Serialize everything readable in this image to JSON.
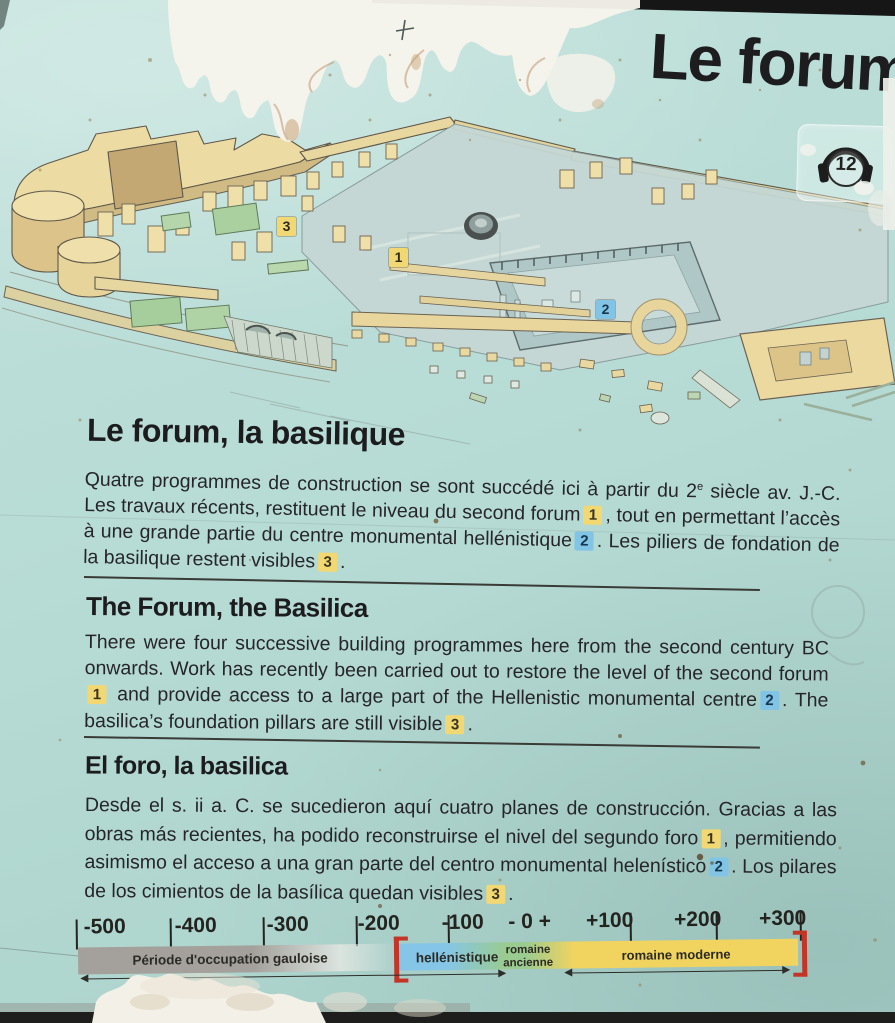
{
  "panel": {
    "title": "Le forum",
    "audio_number": "12"
  },
  "map": {
    "markers": [
      {
        "n": "3",
        "color": "yellow"
      },
      {
        "n": "1",
        "color": "yellow"
      },
      {
        "n": "2",
        "color": "blue"
      }
    ]
  },
  "sections": [
    {
      "id": "fr",
      "heading": "Le forum, la basilique",
      "segments": [
        {
          "t": "text",
          "v": "Quatre programmes de construction se sont succédé ici à partir du 2"
        },
        {
          "t": "sup",
          "v": "e"
        },
        {
          "t": "text",
          "v": " siècle av. J.-C. Les travaux récents, restituent le niveau du second forum"
        },
        {
          "t": "marker",
          "v": "1",
          "color": "yellow"
        },
        {
          "t": "text",
          "v": ", tout en permettant l’accès à une grande partie du centre monumental hellénistique"
        },
        {
          "t": "marker",
          "v": "2",
          "color": "blue"
        },
        {
          "t": "text",
          "v": ". Les piliers de fondation de la basilique restent visibles"
        },
        {
          "t": "marker",
          "v": "3",
          "color": "yellow"
        },
        {
          "t": "text",
          "v": "."
        }
      ]
    },
    {
      "id": "en",
      "heading": "The Forum, the Basilica",
      "segments": [
        {
          "t": "text",
          "v": "There were four successive building programmes here from the second century BC onwards. Work has recently been carried out to restore the level of the second forum"
        },
        {
          "t": "marker",
          "v": "1",
          "color": "yellow"
        },
        {
          "t": "text",
          "v": " and provide access to a large part of the Hellenistic monumental centre"
        },
        {
          "t": "marker",
          "v": "2",
          "color": "blue"
        },
        {
          "t": "text",
          "v": ". The basilica’s foundation pillars are still visible"
        },
        {
          "t": "marker",
          "v": "3",
          "color": "yellow"
        },
        {
          "t": "text",
          "v": "."
        }
      ]
    },
    {
      "id": "es",
      "heading": "El foro, la basilica",
      "segments": [
        {
          "t": "text",
          "v": "Desde el s. ii a. C. se sucedieron aquí cuatro planes de construcción. Gracias a las obras más recientes, ha podido reconstruirse el nivel del segundo foro"
        },
        {
          "t": "marker",
          "v": "1",
          "color": "yellow"
        },
        {
          "t": "text",
          "v": ", permitiendo asimismo el acceso a una gran parte del centro monumental helenístico"
        },
        {
          "t": "marker",
          "v": "2",
          "color": "blue"
        },
        {
          "t": "text",
          "v": ". Los pilares de los cimientos de la basílica quedan visibles"
        },
        {
          "t": "marker",
          "v": "3",
          "color": "yellow"
        },
        {
          "t": "text",
          "v": "."
        }
      ]
    }
  ],
  "timeline": {
    "ticks": [
      {
        "label": "-500",
        "tick_side": "left"
      },
      {
        "label": "-400",
        "tick_side": "left"
      },
      {
        "label": "-300",
        "tick_side": "left"
      },
      {
        "label": "-200",
        "tick_side": "left"
      },
      {
        "label": "-100",
        "tick_side": "left"
      },
      {
        "label": "- 0 +",
        "tick_side": "none"
      },
      {
        "label": "+100",
        "tick_side": "right"
      },
      {
        "label": "+200",
        "tick_side": "right"
      },
      {
        "label": "+300",
        "tick_side": "right"
      }
    ],
    "periods": [
      {
        "label": "Période d'occupation gauloise",
        "color": "#a4a19c",
        "approx_start": -500,
        "approx_end": -160
      },
      {
        "label": "hellénistique",
        "color": "#85c6e8",
        "approx_start": -160,
        "approx_end": -60
      },
      {
        "label": "romaine ancienne",
        "color": "#9acb90",
        "approx_start": -60,
        "approx_end": 40
      },
      {
        "label": "romaine moderne",
        "color": "#f0d45f",
        "approx_start": 40,
        "approx_end": 300
      }
    ],
    "bracket_color": "#c23527"
  }
}
